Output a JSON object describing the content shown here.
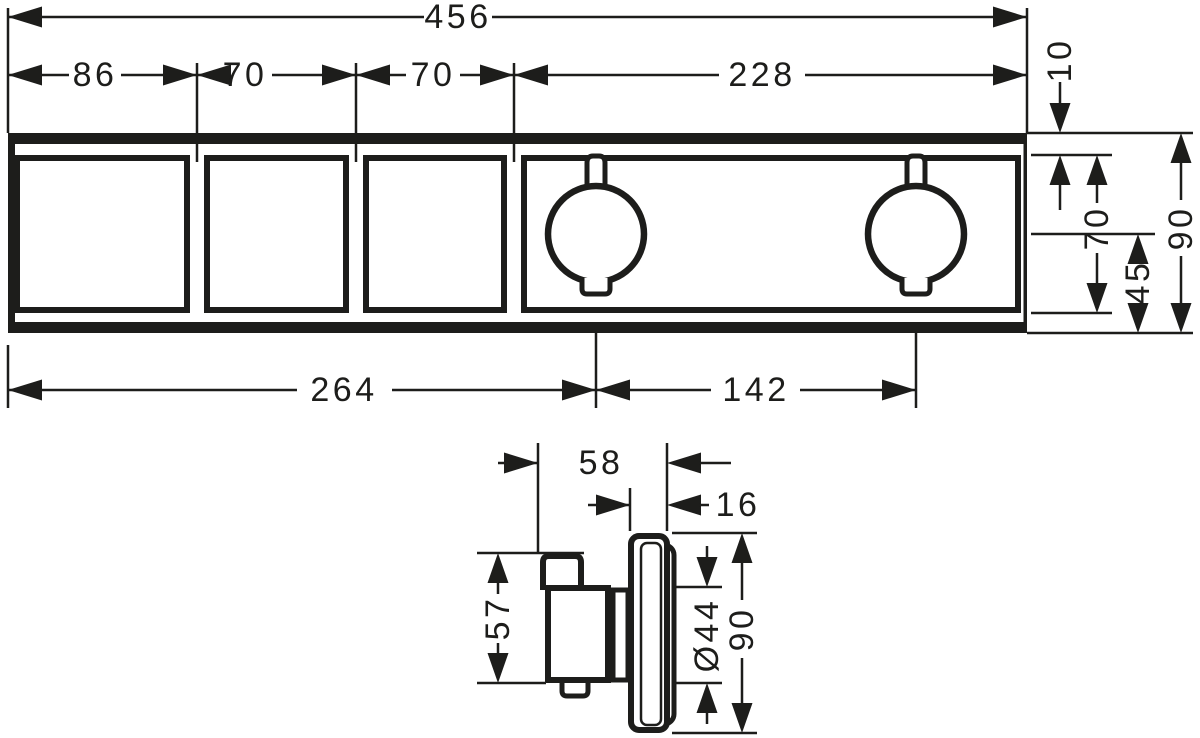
{
  "colors": {
    "line": "#1d1d1b",
    "background": "#ffffff"
  },
  "front_view": {
    "total_width": "456",
    "module_width_1": "86",
    "module_width_2": "70",
    "module_width_3": "70",
    "module_width_4": "228",
    "top_edge_offset": "10",
    "module_height": "70",
    "panel_height": "90",
    "handle_center_to_bottom": "45",
    "left_edge_to_handle_1": "264",
    "handle_1_to_handle_2": "142"
  },
  "side_view": {
    "total_depth": "58",
    "plate_depth": "16",
    "body_height": "57",
    "handle_diameter": "Ø44",
    "plate_height": "90"
  }
}
